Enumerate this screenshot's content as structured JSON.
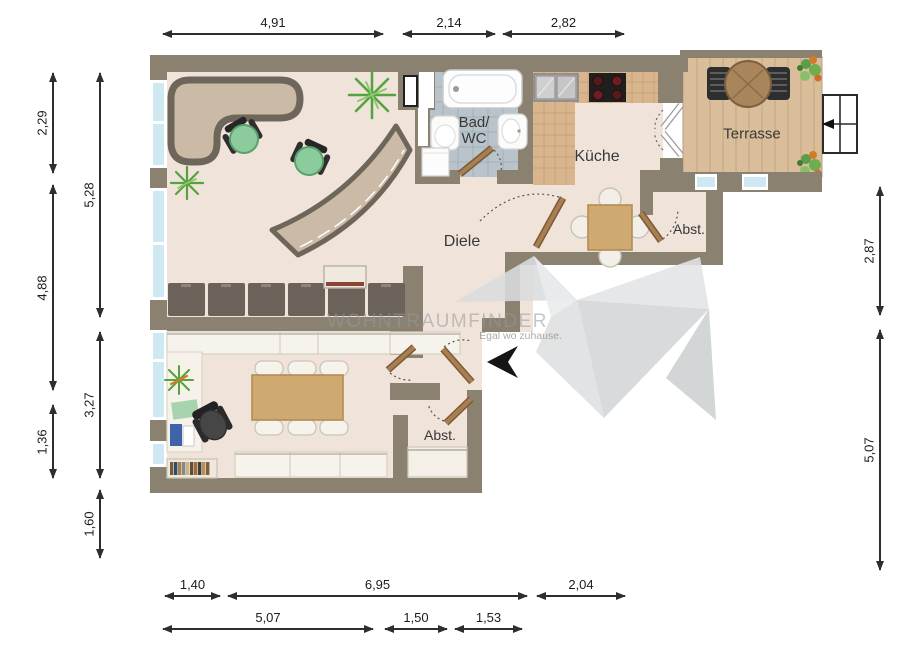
{
  "watermark": {
    "brand": "WOHNTRAUMFINDER",
    "tagline": "Egal wo zuhause."
  },
  "rooms": {
    "bad_line1": "Bad/",
    "bad_line2": "WC",
    "kueche": "Küche",
    "diele": "Diele",
    "abst_top": "Abst.",
    "abst_bottom": "Abst.",
    "terrasse": "Terrasse"
  },
  "dimensions": {
    "top": [
      "4,91",
      "2,14",
      "2,82"
    ],
    "left_outer": [
      "2,29",
      "4,88",
      "1,36"
    ],
    "left_inner": [
      "5,28",
      "3,27",
      "1,60"
    ],
    "right": [
      "2,87",
      "5,07"
    ],
    "bottom_upper": [
      "1,40",
      "6,95",
      "2,04"
    ],
    "bottom_lower": [
      "5,07",
      "1,50",
      "1,53"
    ]
  },
  "icons": {
    "north_arrow": "left-pointing solid arrow",
    "logo": "origami-bird watermark",
    "window_symbol": "2x2 glazed window with opening arrow"
  },
  "colors": {
    "wall": "#8b8170",
    "floor": "#f0e3da",
    "kitchen_tile": "#d8b58d",
    "bath_tile": "#b9c3ca",
    "terrace_wood": "#dabd9a",
    "door_wood": "#a87f52",
    "furniture_dark": "#6b635a",
    "counter_tan": "#cbbaa5",
    "chair_green": "#8ccb9b",
    "window_glass": "#cfe9f2",
    "dimension_line": "#2e2e2e",
    "watermark_gray": "#9aa0a2"
  }
}
